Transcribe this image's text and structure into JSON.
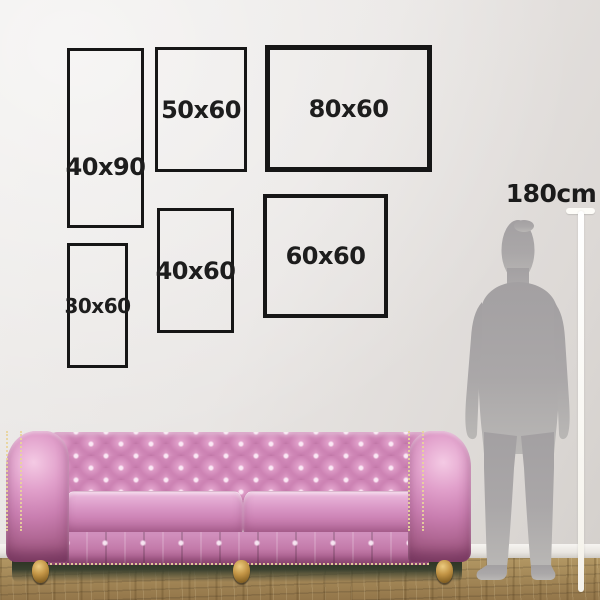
{
  "frames": [
    {
      "label": "40x90"
    },
    {
      "label": "50x60"
    },
    {
      "label": "80x60"
    },
    {
      "label": "30x60"
    },
    {
      "label": "40x60"
    },
    {
      "label": "60x60"
    }
  ],
  "height_marker": {
    "label": "180cm"
  },
  "colors": {
    "frame_border": "#161616",
    "label_text": "#1d1d1d",
    "wall_light": "#edebe9",
    "wall_dark": "#d3cfcb",
    "baseboard": "#f2f0ec",
    "floor_wood": "#a78d58",
    "sofa_pink": "#cd83b4",
    "sofa_pink_highlight": "#edbcde",
    "sofa_pink_shadow": "#9c527f",
    "nailhead_gold": "#e9d49c",
    "leg_gold": "#c29445",
    "silhouette_gray": "#a9a6a8",
    "ruler_white": "#fdfcf8",
    "under_sofa_shadow": "#39402e"
  }
}
